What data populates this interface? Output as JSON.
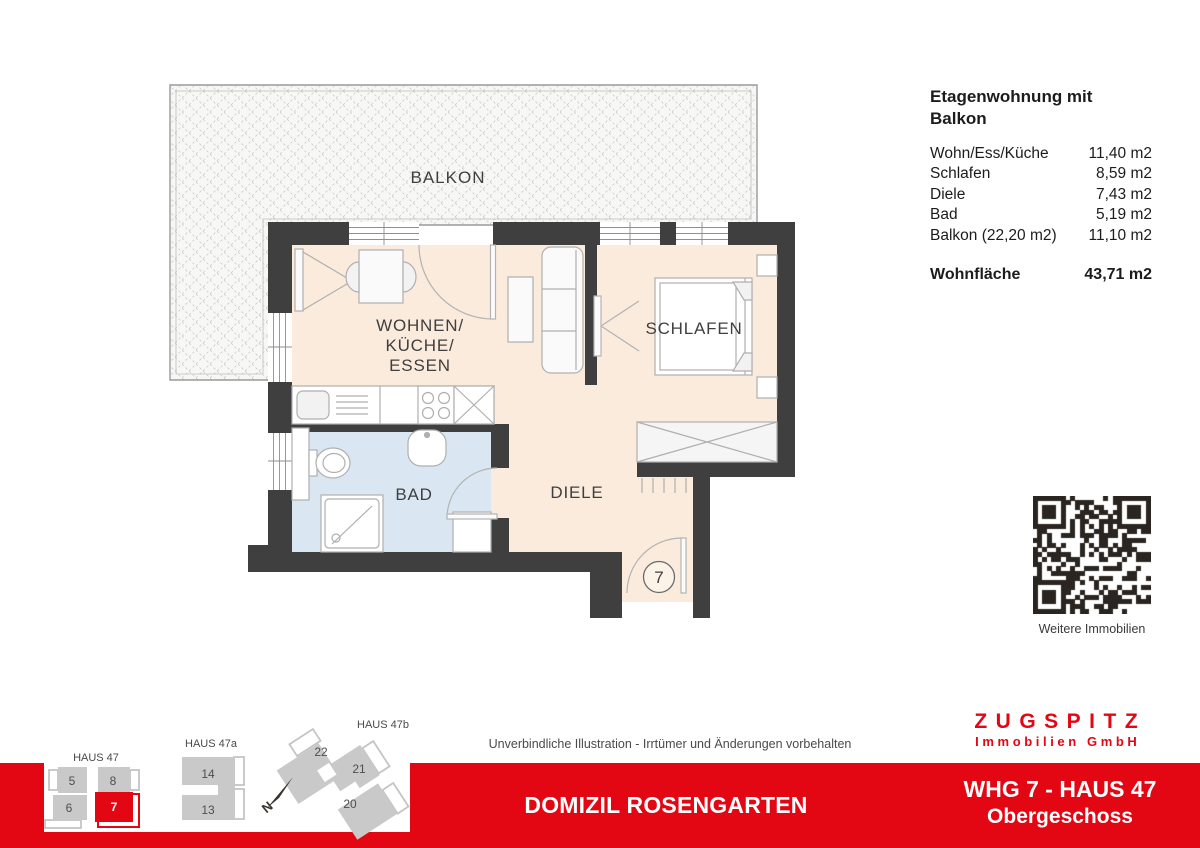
{
  "colors": {
    "accent_red": "#E30613",
    "wall_dark": "#3F3F3F",
    "floor_living": "#FAEBDD",
    "floor_bath": "#DAE7F2",
    "sitemap_gray": "#C9C9C9"
  },
  "summary": {
    "title": "Etagenwohnung mit Balkon",
    "rows": [
      {
        "label": "Wohn/Ess/Küche",
        "value": "11,40 m2"
      },
      {
        "label": "Schlafen",
        "value": "8,59 m2"
      },
      {
        "label": "Diele",
        "value": "7,43 m2"
      },
      {
        "label": "Bad",
        "value": "5,19 m2"
      },
      {
        "label": "Balkon (22,20 m2)",
        "value": "11,10 m2"
      }
    ],
    "total": {
      "label": "Wohnfläche",
      "value": "43,71 m2"
    }
  },
  "floorplan": {
    "rooms": {
      "balcony": "BALKON",
      "living_lines": [
        "WOHNEN/",
        "KÜCHE/",
        "ESSEN"
      ],
      "bedroom": "SCHLAFEN",
      "bath": "BAD",
      "hall": "DIELE"
    },
    "unit_number": "7"
  },
  "qr": {
    "caption": "Weitere Immobilien"
  },
  "sitemap": {
    "haus47": {
      "label": "HAUS 47",
      "units": [
        "5",
        "8",
        "6",
        "7"
      ],
      "highlighted_unit": "7"
    },
    "haus47a": {
      "label": "HAUS 47a",
      "units": [
        "14",
        "13"
      ]
    },
    "haus47b": {
      "label": "HAUS 47b",
      "units": [
        "22",
        "21",
        "20"
      ]
    }
  },
  "disclaimer": "Unverbindliche Illustration - Irrtümer und Änderungen vorbehalten",
  "brand": {
    "name": "ZUGSPITZ",
    "subtitle": "Immobilien GmbH"
  },
  "footer": {
    "project": "DOMIZIL ROSENGARTEN",
    "unit": "WHG 7 - HAUS 47",
    "floor": "Obergeschoss"
  }
}
